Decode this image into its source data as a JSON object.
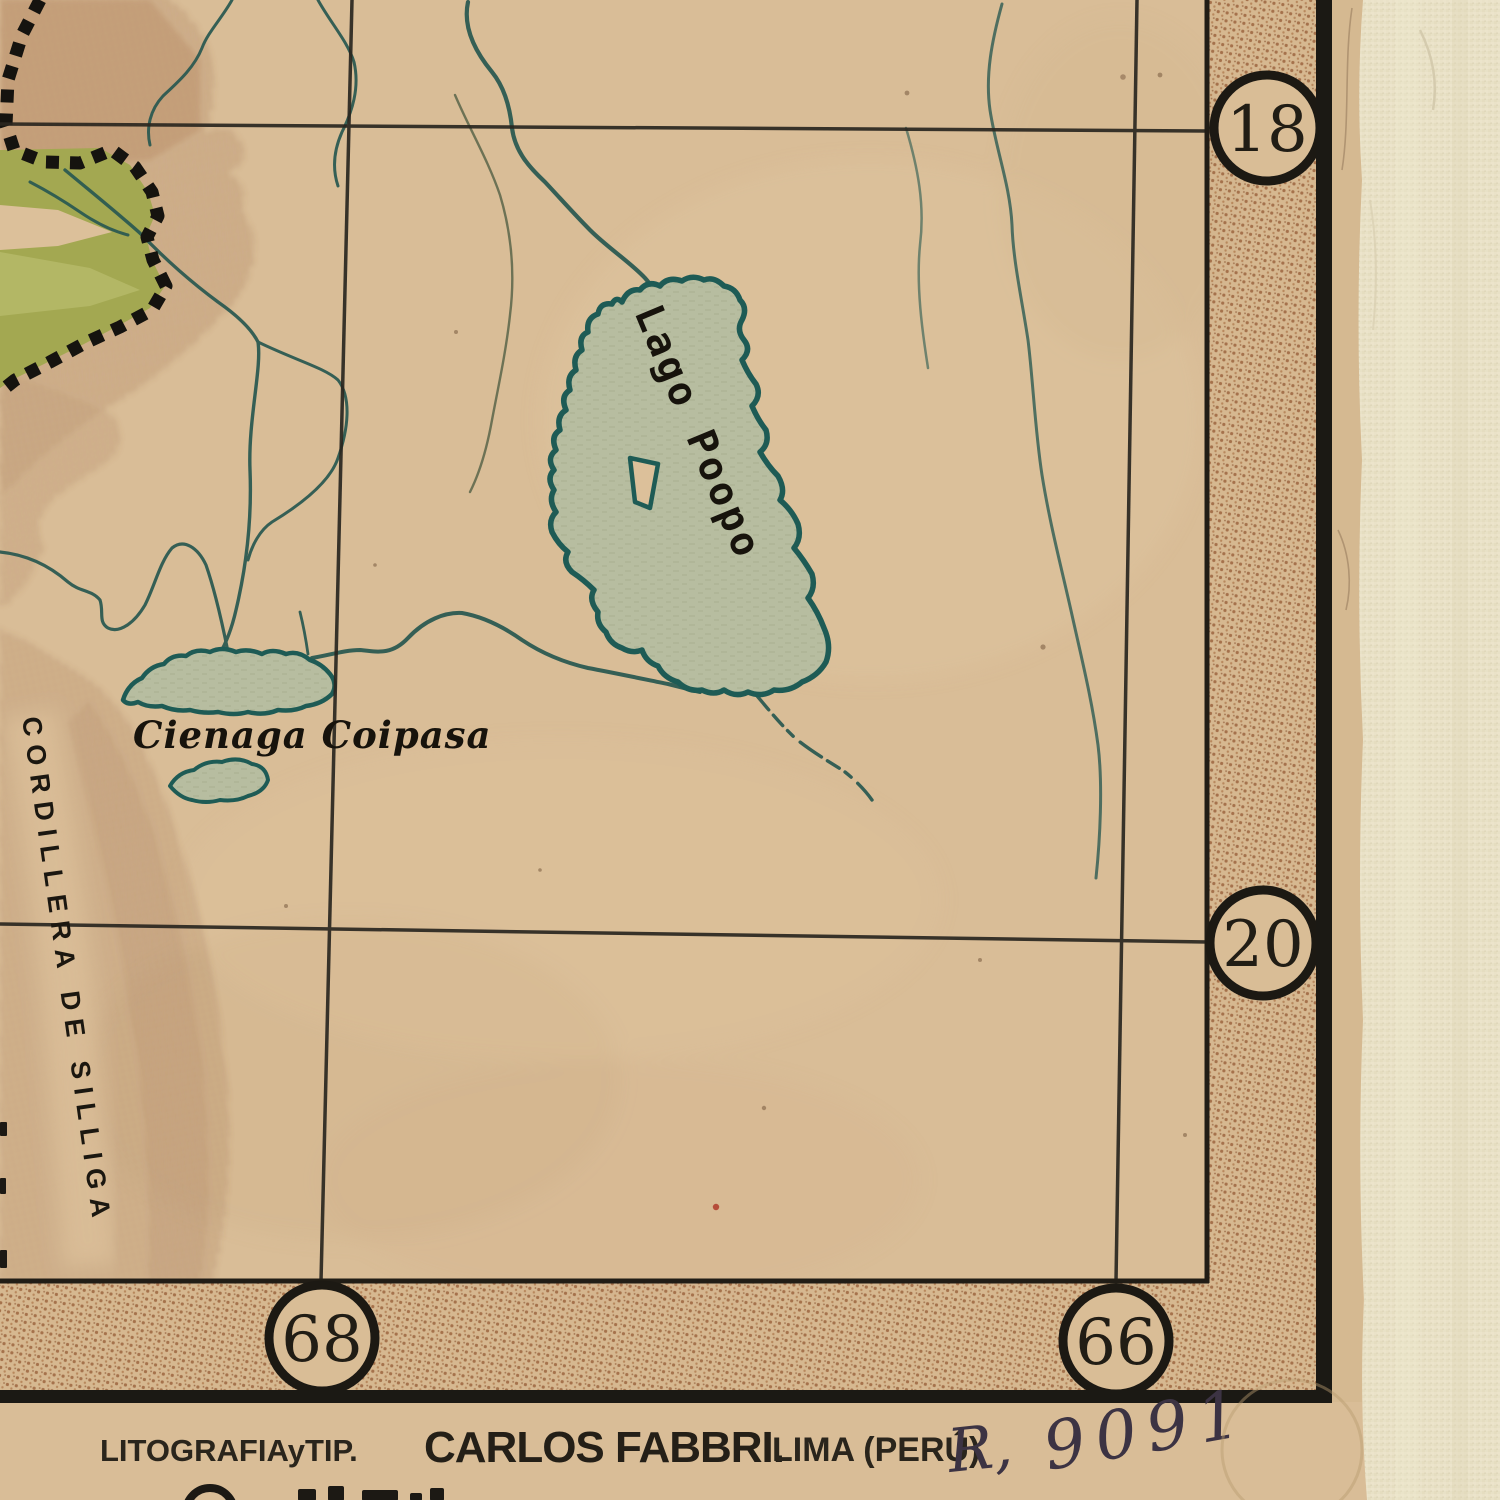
{
  "map": {
    "labels": {
      "lake": "Lago Poopo",
      "marsh": "Cienaga Coipasa",
      "range": "CORDILLERA DE SILLIGA"
    },
    "graticule": {
      "parallels": [
        "18",
        "20"
      ],
      "meridians": [
        "68",
        "66"
      ]
    },
    "imprint": {
      "litho": "LITOGRAFIAyTIP.",
      "printer": "CARLOS FABBRI.",
      "city": "LIMA (PERÚ)"
    },
    "note": {
      "prefix": "R,",
      "number": "9091"
    },
    "colors": {
      "paper": "#d9bd97",
      "band_dots": "#9d6540",
      "mountain": "#8f5c42",
      "green_terrain": "#a3a851",
      "lake_fill": "#b7bda0",
      "water_outline": "#1e5b55",
      "river": "#2d5a52",
      "ink": "#211d15",
      "handwriting": "#3c3343",
      "fabric": "#e8e1c6"
    }
  }
}
